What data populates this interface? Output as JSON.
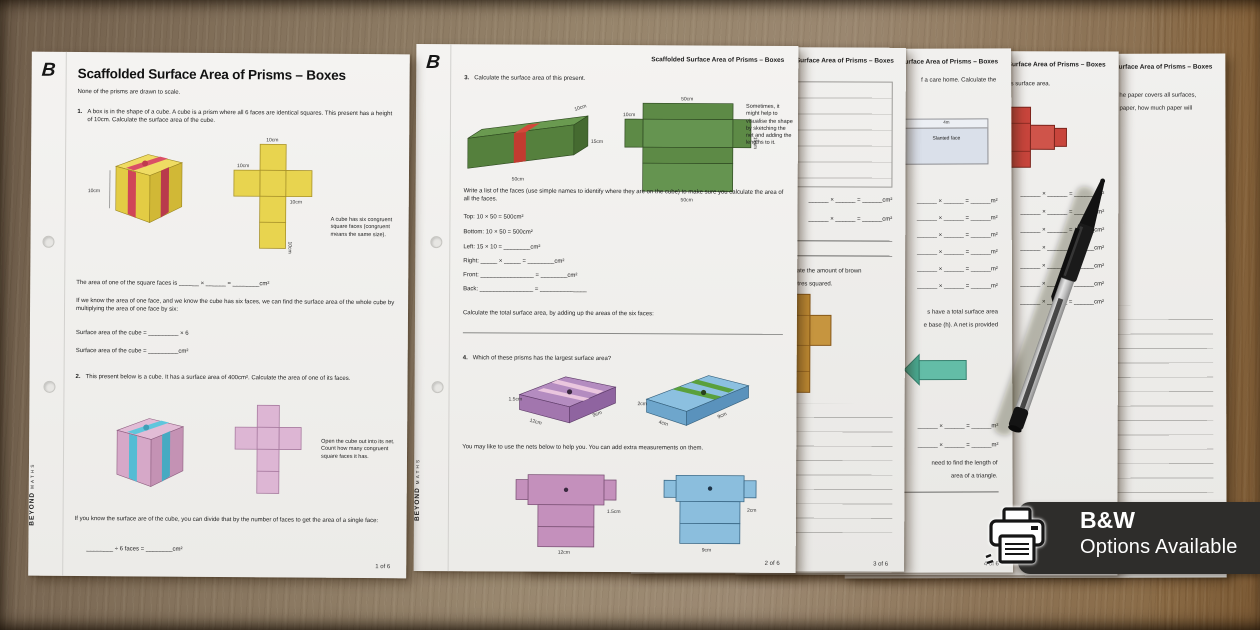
{
  "brand": {
    "logo_letter": "B",
    "edge_primary": "BEYOND",
    "edge_secondary": "MATHS"
  },
  "badge": {
    "title": "B&W",
    "subtitle": "Options Available"
  },
  "worksheet_title": "Scaffolded Surface Area of Prisms – Boxes",
  "page1": {
    "subtitle": "None of the prisms are drawn to scale.",
    "page_number": "1 of 6",
    "q1_number": "1.",
    "q1_text": "A box is in the shape of a cube. A cube is a prism where all 6 faces are identical squares. This present has a height of 10cm. Calculate the surface area of the cube.",
    "q1_cube_label": "10cm",
    "q1_net_label_top": "10cm",
    "q1_net_label_left": "10cm",
    "q1_net_label_right": "10cm",
    "q1_net_label_bottom": "10cm",
    "q1_note": "A cube has six congruent square faces (congruent means the same size).",
    "q1_area_line": "The area of one of the square faces is ______ × ______ = ________cm²",
    "q1_para": "If we know the area of one face, and we know the cube has six faces, we can find the surface area of the whole cube by multiplying the area of one face by six:",
    "q1_sa_line1": "Surface area of the cube = _________ × 6",
    "q1_sa_line2": "Surface area of the cube = _________cm²",
    "q2_number": "2.",
    "q2_text": "This present below is a cube. It has a surface area of 400cm². Calculate the area of one of its faces.",
    "q2_note": "Open the cube out into its net. Count how many congruent square faces it has.",
    "q2_para": "If you know the surface are of the cube, you can divide that by the number of faces to get the area of a single face:",
    "q2_line": "________ ÷ 6 faces = ________cm²"
  },
  "page2": {
    "header": "Scaffolded Surface Area of Prisms – Boxes",
    "page_number": "2 of 6",
    "q3_number": "3.",
    "q3_text": "Calculate the surface area of this present.",
    "q3_box_label_top": "10cm",
    "q3_box_label_side": "15cm",
    "q3_box_label_bottom": "50cm",
    "q3_net_label_top": "50cm",
    "q3_net_label_bottom": "50cm",
    "q3_net_label_left": "10cm",
    "q3_net_label_right": "15cm",
    "q3_note": "Sometimes, it might help to visualise the shape by sketching the net and adding the lengths to it.",
    "q3_para": "Write a list of the faces (use simple names to identify where they are on the cube) to make sure you calculate the area of all the faces.",
    "q3_faces": [
      "Top: 10 × 50 = 500cm²",
      "Bottom: 10 × 50 = 500cm²",
      "Left: 15 × 10 = ________cm²",
      "Right: _____ × _____ = ________cm²",
      "Front: ________________ = ________cm²",
      "Back: ________________ = ______________"
    ],
    "q3_total": "Calculate the total surface area, by adding up the areas of the six faces:",
    "q4_number": "4.",
    "q4_text": "Which of these prisms has the largest surface area?",
    "q4_purple_height": "1.5cm",
    "q4_purple_front": "12cm",
    "q4_purple_side": "9cm",
    "q4_blue_height": "2cm",
    "q4_blue_front": "4cm",
    "q4_blue_side": "9cm",
    "q4_para": "You may like to use the nets below to help you. You can add extra measurements on them.",
    "q4_purple_net_bottom": "12cm",
    "q4_purple_net_side": "1.5cm",
    "q4_blue_net_bottom": "9cm",
    "q4_blue_net_side": "2cm"
  },
  "page3": {
    "header": "Scaffolded Surface Area of Prisms – Boxes",
    "eq_cm": "______ × ______ = ______cm²",
    "fragment1": "culate the amount of brown",
    "fragment2": "metres squared.",
    "page_number": "3 of 6"
  },
  "page4": {
    "header": "Scaffolded Surface Area of Prisms – Boxes",
    "fragment_intro": "f a care home. Calculate the",
    "diagram_top_label": "4m",
    "diagram_label": "Slanted face",
    "eq_m": "______ × ______ = ______m²",
    "fragment_mid1": "s have a total surface area",
    "fragment_mid2": "e base (h). A net is provided",
    "fragment_low1": "need to find the length of",
    "fragment_low2": "area of a triangle.",
    "page_number": "4 of 6"
  },
  "page5": {
    "header": "Scaffolded Surface Area of Prisms – Boxes",
    "fragment_intro": "s surface area.",
    "eq_cm": "______ × ______ = ______cm²"
  },
  "page6": {
    "header": "Scaffolded Surface Area of Prisms – Boxes",
    "fragment1": "he paper covers all surfaces,",
    "fragment2": "paper, how much paper will"
  }
}
